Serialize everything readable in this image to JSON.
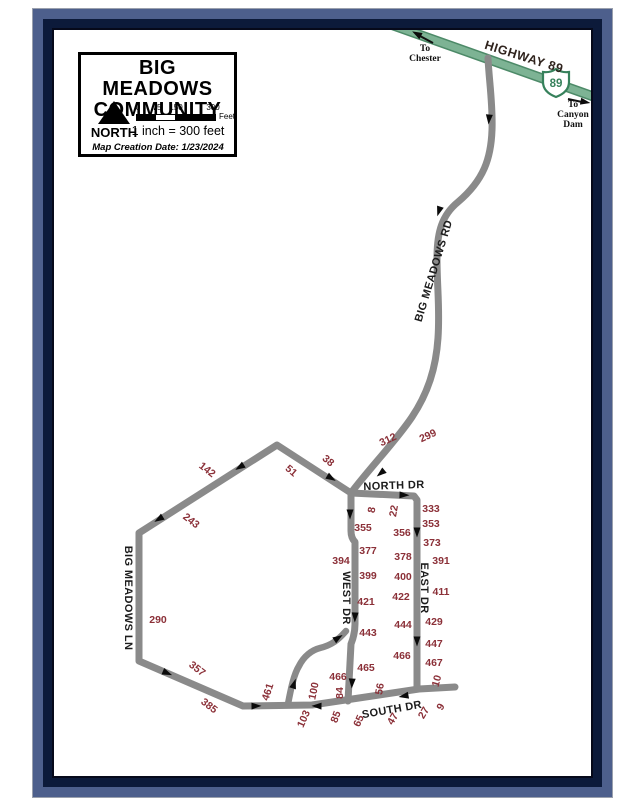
{
  "colors": {
    "frame_slate": "#4d5f8c",
    "frame_navy": "#0c1a3a",
    "road_gray": "#8a8a8a",
    "highway_green": "#7db394",
    "highway_green_dark": "#4d8a68",
    "address_red": "#8b3038",
    "label_black": "#1c1c1c"
  },
  "legend": {
    "title_line1": "BIG MEADOWS",
    "title_line2": "COMMUNITY",
    "north_label": "NORTH",
    "scale_ticks": [
      "0",
      "75",
      "150",
      "300"
    ],
    "scale_unit": "Feet",
    "scale_text": "1 inch = 300 feet",
    "creation_date": "Map Creation Date: 1/23/2024"
  },
  "highway": {
    "name": "HIGHWAY 89",
    "shield_number": "89",
    "chester_lines": [
      "To",
      "Chester"
    ],
    "canyon_lines": [
      "To",
      "Canyon",
      "Dam"
    ]
  },
  "roads": {
    "big_meadows_rd": "BIG MEADOWS RD",
    "big_meadows_ln": "BIG MEADOWS LN",
    "north_dr": "NORTH DR",
    "south_dr": "SOUTH DR",
    "west_dr": "WEST DR",
    "east_dr": "EAST DR"
  },
  "map": {
    "address_labels": [
      {
        "t": "142",
        "x": 207,
        "y": 470,
        "r": 38
      },
      {
        "t": "243",
        "x": 191,
        "y": 521,
        "r": 38
      },
      {
        "t": "51",
        "x": 291,
        "y": 471,
        "r": 40
      },
      {
        "t": "38",
        "x": 328,
        "y": 461,
        "r": 40
      },
      {
        "t": "290",
        "x": 158,
        "y": 620,
        "r": 0
      },
      {
        "t": "357",
        "x": 197,
        "y": 669,
        "r": 38
      },
      {
        "t": "385",
        "x": 209,
        "y": 706,
        "r": 38
      },
      {
        "t": "461",
        "x": 268,
        "y": 692,
        "r": -72
      },
      {
        "t": "103",
        "x": 304,
        "y": 719,
        "r": -66
      },
      {
        "t": "100",
        "x": 314,
        "y": 691,
        "r": -78
      },
      {
        "t": "466",
        "x": 338,
        "y": 677,
        "r": 0
      },
      {
        "t": "84",
        "x": 340,
        "y": 693,
        "r": -90
      },
      {
        "t": "85",
        "x": 336,
        "y": 717,
        "r": -70
      },
      {
        "t": "65",
        "x": 359,
        "y": 721,
        "r": -66
      },
      {
        "t": "56",
        "x": 380,
        "y": 689,
        "r": -80
      },
      {
        "t": "47",
        "x": 393,
        "y": 719,
        "r": -60
      },
      {
        "t": "27",
        "x": 424,
        "y": 713,
        "r": -60
      },
      {
        "t": "9",
        "x": 441,
        "y": 707,
        "r": -60
      },
      {
        "t": "10",
        "x": 437,
        "y": 681,
        "r": -75
      },
      {
        "t": "312",
        "x": 388,
        "y": 440,
        "r": -25
      },
      {
        "t": "299",
        "x": 428,
        "y": 436,
        "r": -25
      },
      {
        "t": "8",
        "x": 372,
        "y": 510,
        "r": -80
      },
      {
        "t": "22",
        "x": 394,
        "y": 511,
        "r": -80
      },
      {
        "t": "333",
        "x": 431,
        "y": 509,
        "r": 0
      },
      {
        "t": "353",
        "x": 431,
        "y": 524,
        "r": 0
      },
      {
        "t": "355",
        "x": 363,
        "y": 528,
        "r": 0
      },
      {
        "t": "356",
        "x": 402,
        "y": 533,
        "r": 0
      },
      {
        "t": "373",
        "x": 432,
        "y": 543,
        "r": 0
      },
      {
        "t": "377",
        "x": 368,
        "y": 551,
        "r": 0
      },
      {
        "t": "378",
        "x": 403,
        "y": 557,
        "r": 0
      },
      {
        "t": "391",
        "x": 441,
        "y": 561,
        "r": 0
      },
      {
        "t": "394",
        "x": 341,
        "y": 561,
        "r": 0
      },
      {
        "t": "399",
        "x": 368,
        "y": 576,
        "r": 0
      },
      {
        "t": "400",
        "x": 403,
        "y": 577,
        "r": 0
      },
      {
        "t": "411",
        "x": 441,
        "y": 592,
        "r": 0
      },
      {
        "t": "421",
        "x": 366,
        "y": 602,
        "r": 0
      },
      {
        "t": "422",
        "x": 401,
        "y": 597,
        "r": 0
      },
      {
        "t": "429",
        "x": 434,
        "y": 622,
        "r": 0
      },
      {
        "t": "443",
        "x": 368,
        "y": 633,
        "r": 0
      },
      {
        "t": "444",
        "x": 403,
        "y": 625,
        "r": 0
      },
      {
        "t": "447",
        "x": 434,
        "y": 644,
        "r": 0
      },
      {
        "t": "465",
        "x": 366,
        "y": 668,
        "r": 0
      },
      {
        "t": "466",
        "x": 402,
        "y": 656,
        "r": 0
      },
      {
        "t": "467",
        "x": 434,
        "y": 663,
        "r": 0
      }
    ]
  }
}
